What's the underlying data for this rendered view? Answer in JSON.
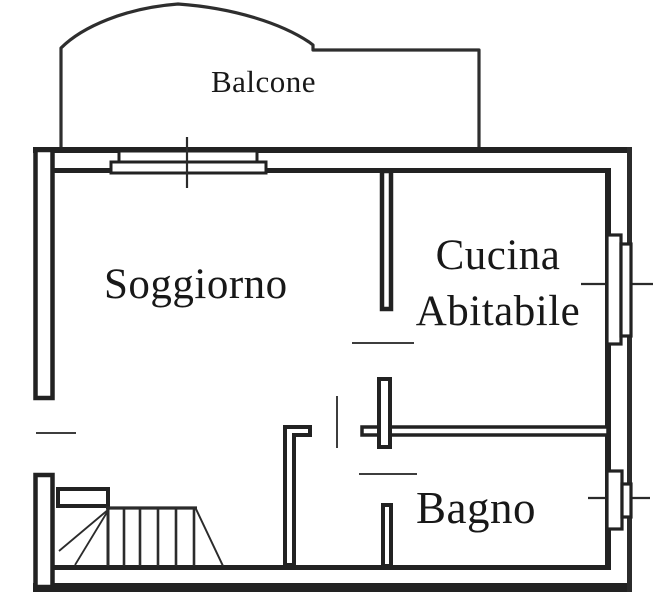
{
  "colors": {
    "background": "#ffffff",
    "line": "#222222",
    "thin_line": "#3d3d3d"
  },
  "diagram": {
    "type": "floor-plan",
    "rooms": {
      "balcone": {
        "label": "Balcone"
      },
      "soggiorno": {
        "label": "Soggiorno"
      },
      "cucina": {
        "label_line1": "Cucina",
        "label_line2": "Abitabile"
      },
      "bagno": {
        "label": "Bagno"
      }
    }
  }
}
